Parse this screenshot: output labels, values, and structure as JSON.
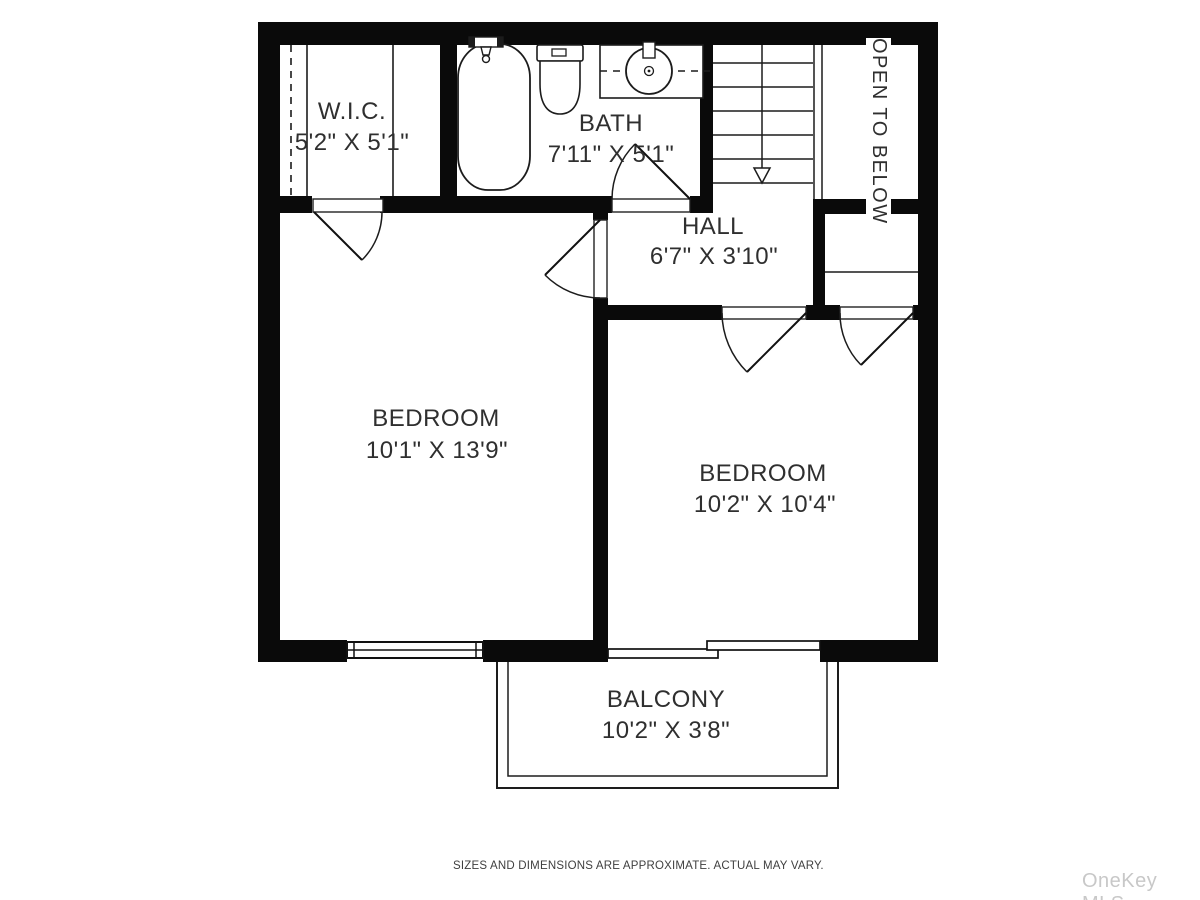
{
  "colors": {
    "background": "#ffffff",
    "wall": "#0a0a0a",
    "line": "#1c1c1c",
    "text": "#2f2f2f",
    "watermark": "#c8c8c8"
  },
  "floorplan": {
    "rooms": [
      {
        "name": "W.I.C.",
        "dimensions": "5'2\" X 5'1\""
      },
      {
        "name": "BATH",
        "dimensions": "7'11\" X 5'1\""
      },
      {
        "name": "HALL",
        "dimensions": "6'7\" X 3'10\""
      },
      {
        "name": "BEDROOM",
        "dimensions": "10'1\" X 13'9\""
      },
      {
        "name": "BEDROOM",
        "dimensions": "10'2\" X 10'4\""
      },
      {
        "name": "BALCONY",
        "dimensions": "10'2\" X 3'8\""
      }
    ],
    "annotations": {
      "open_to_below": "OPEN TO BELOW"
    },
    "fixtures": [
      "bathtub",
      "toilet",
      "sink-vanity",
      "stairs-down",
      "closet-rod",
      "closet-shelf",
      "window",
      "sliding-door",
      "balcony-railing"
    ]
  },
  "footer": {
    "disclaimer": "SIZES AND DIMENSIONS ARE APPROXIMATE. ACTUAL MAY VARY."
  },
  "watermark": {
    "text": "OneKey MLS"
  }
}
